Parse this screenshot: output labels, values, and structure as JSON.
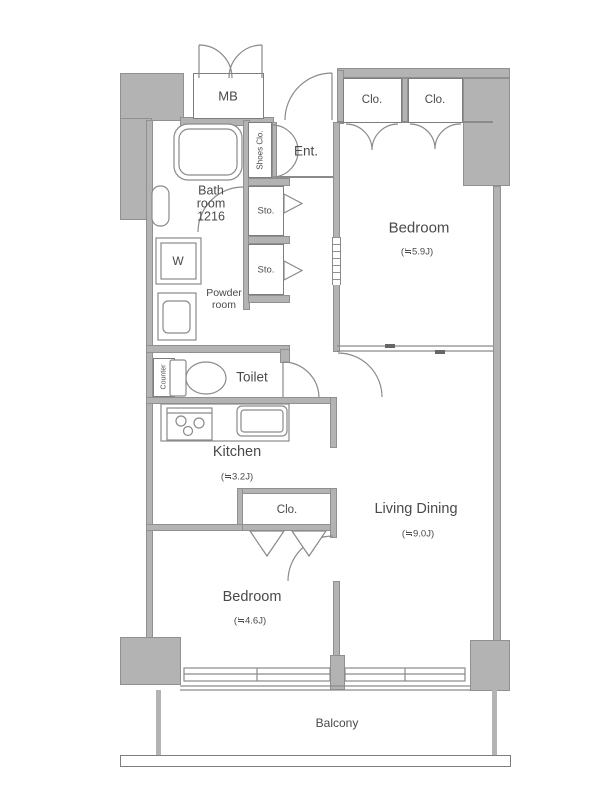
{
  "meta": {
    "type": "apartment-floor-plan"
  },
  "colors": {
    "wall": "#b3b3b3",
    "line": "#8a8a8a",
    "text": "#4a4a4a",
    "bg": "#ffffff"
  },
  "labels": {
    "mb": "MB",
    "ent": "Ent.",
    "shoes_clo": "Shoes Clo.",
    "clo_top_left": "Clo.",
    "clo_top_right": "Clo.",
    "clo_mid": "Clo.",
    "sto_1": "Sto.",
    "sto_2": "Sto.",
    "washer": "W",
    "counter": "Counter",
    "toilet": "Toilet",
    "balcony": "Balcony"
  },
  "rooms": {
    "bath": {
      "line1": "Bath",
      "line2": "room",
      "line3": "1216"
    },
    "powder": {
      "line1": "Powder",
      "line2": "room"
    },
    "bedroom_top": {
      "name": "Bedroom",
      "size": "(≒5.9J)"
    },
    "living_dining": {
      "name": "Living Dining",
      "size": "(≒9.0J)"
    },
    "kitchen": {
      "name": "Kitchen",
      "size": "(≒3.2J)"
    },
    "bedroom_bottom": {
      "name": "Bedroom",
      "size": "(≒4.6J)"
    }
  }
}
